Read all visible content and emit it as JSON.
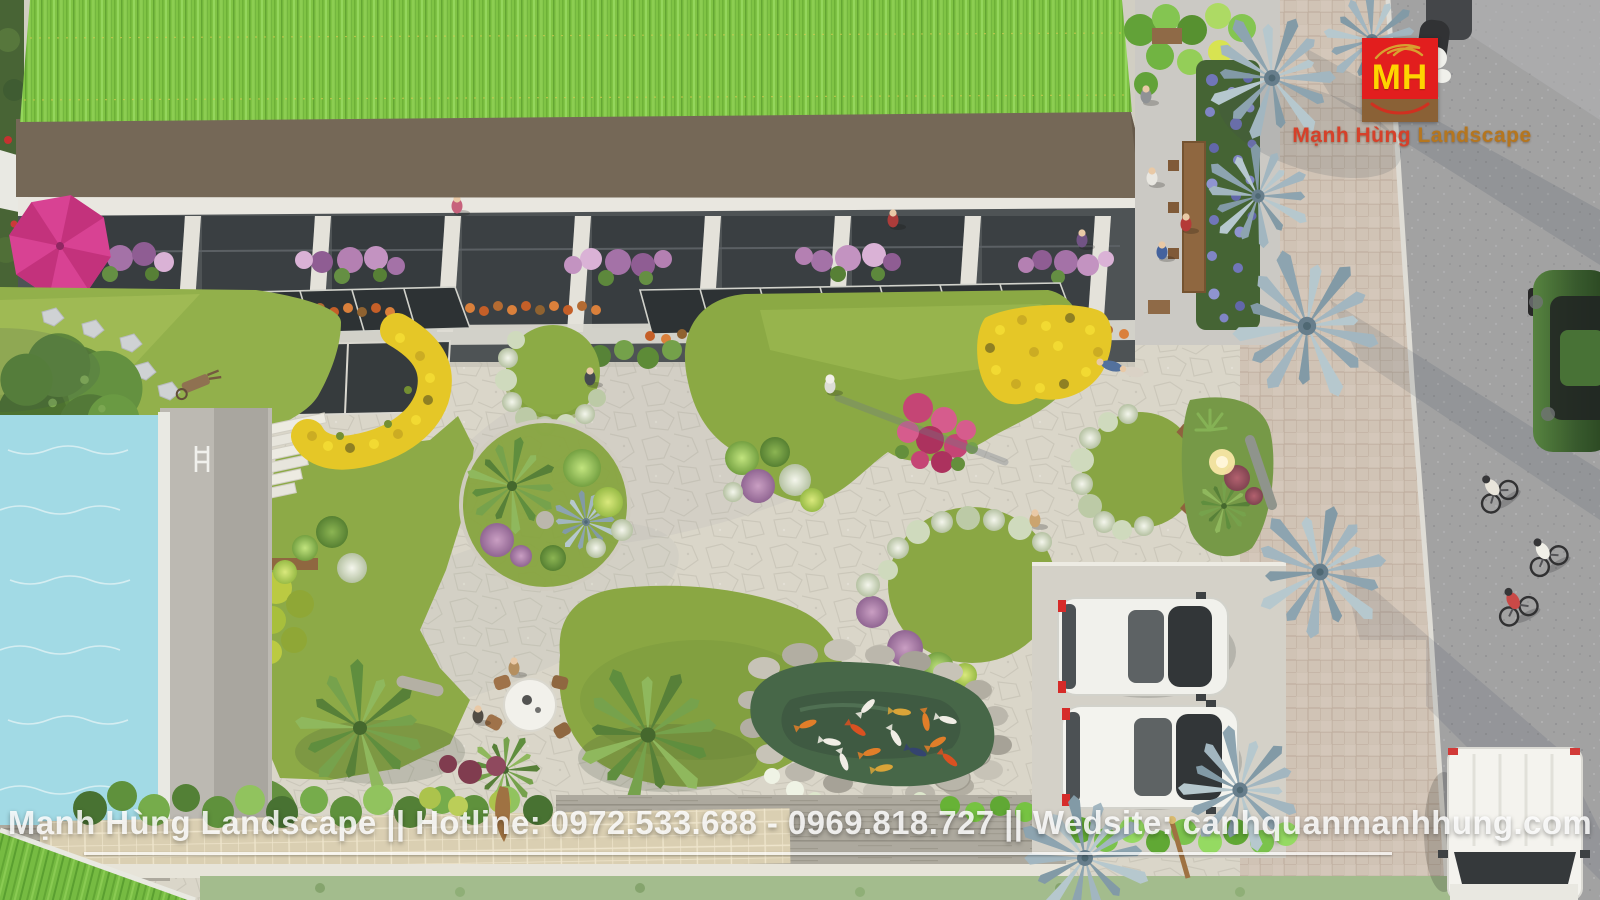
{
  "logo": {
    "monogram": "MH",
    "brand_part1": "Mạnh Hùng",
    "brand_part2": " Landscape",
    "brand_full": "Mạnh Hùng Landscape"
  },
  "watermark": {
    "company": "Mạnh Hùng Landscape",
    "separator": "||",
    "hotline_label": "Hotline:",
    "phone1": "0972.533.688",
    "phone2": "0969.818.727",
    "website_label": "Wedsite:",
    "website": "canhquanmanhhung.com",
    "full": "Mạnh Hùng Landscape || Hotline: 0972.533.688 - 0969.818.727 || Wedsite: canhquanmanhhung.com"
  },
  "palette": {
    "roof_green": "#7ac13e",
    "fascia_brown": "#6e6051",
    "lawn_green": "#86a53e",
    "plaza_stone": "#d8d4c9",
    "pool_cyan": "#9ed9e6",
    "pond_green": "#3e5f41",
    "road_gray": "#9d9da0",
    "paver_beige": "#cec0b4",
    "palm_silver": "#9db3bf",
    "logo_red": "#e21e1e",
    "logo_yellow": "#ffd400",
    "logo_band_brown": "#8a6136",
    "brand_orange": "#b5761f",
    "koi_orange": "#e07820",
    "flower_yellow": "#e4c51e",
    "flower_purple": "#a06ba5",
    "bougainvillea_pink": "#c23b70"
  }
}
